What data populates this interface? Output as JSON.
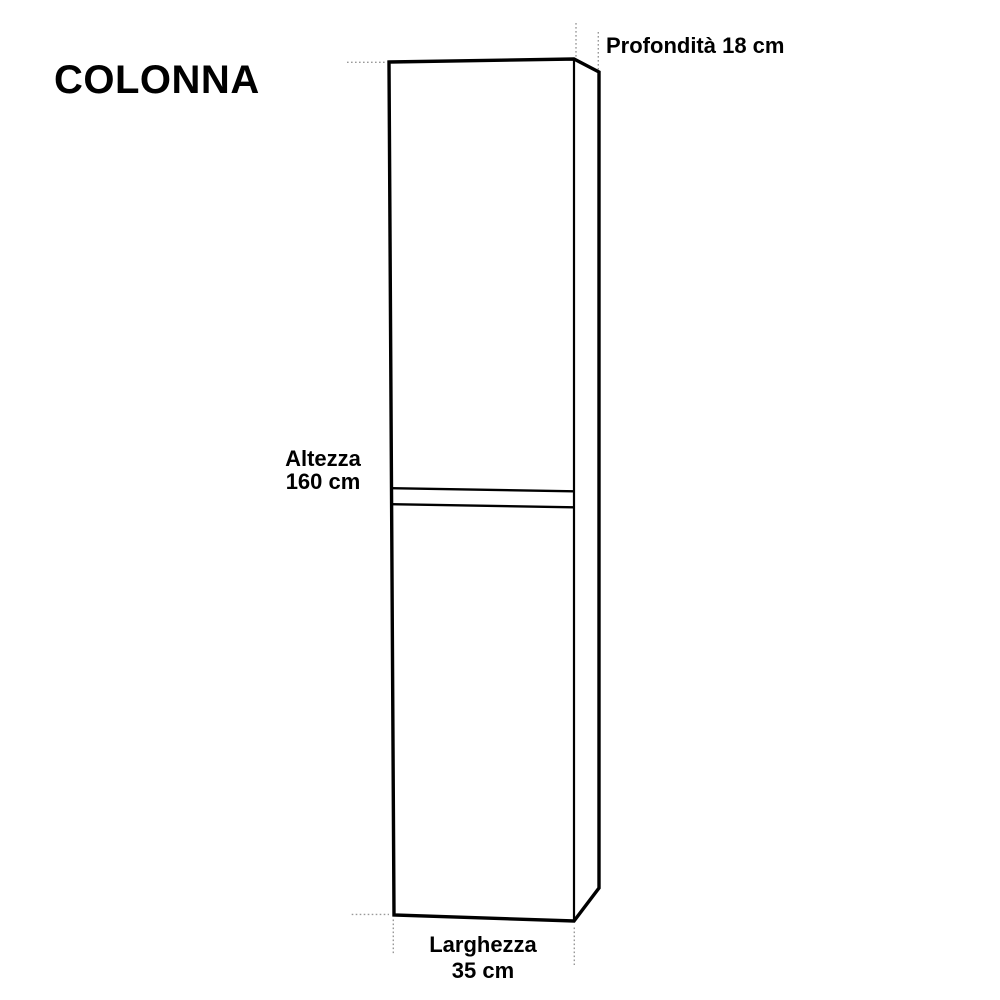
{
  "page": {
    "background": "#ffffff"
  },
  "title": "COLONNA",
  "cabinet": {
    "kind": "tall-column-cabinet-outline",
    "labels": {
      "depth": "Profondità 18 cm",
      "height_line1": "Altezza",
      "height_line2": "160 cm",
      "width_line1": "Larghezza",
      "width_line2": "35 cm"
    },
    "dimensions_cm": {
      "depth": 18,
      "height": 160,
      "width": 35
    },
    "colors": {
      "outline": "#000000",
      "guide": "#999999",
      "text": "#000000"
    }
  }
}
